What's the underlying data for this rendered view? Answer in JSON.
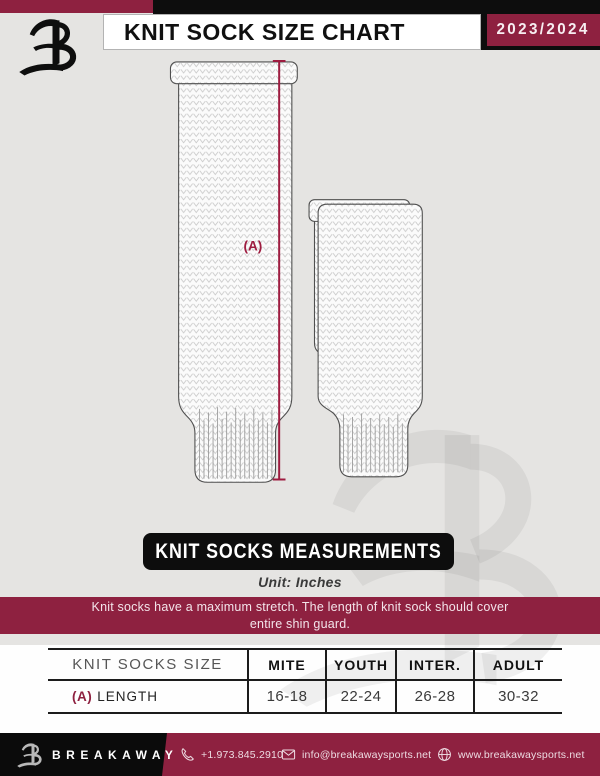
{
  "header": {
    "title": "KNIT SOCK SIZE CHART",
    "season": "2023/2024"
  },
  "diagram": {
    "label_a": "(A)"
  },
  "measurements": {
    "banner": "KNIT SOCKS MEASUREMENTS",
    "unit": "Unit: Inches",
    "note_line1": "Knit socks have a maximum stretch. The length of knit sock should cover",
    "note_line2": "entire shin guard."
  },
  "size_table": {
    "title": "KNIT SOCKS SIZE",
    "columns": [
      "MITE",
      "YOUTH",
      "INTER.",
      "ADULT"
    ],
    "rows": [
      {
        "prefix": "(A)",
        "label": "LENGTH",
        "values": [
          "16-18",
          "22-24",
          "26-28",
          "30-32"
        ]
      }
    ]
  },
  "footer": {
    "brand": "BREAKAWAY",
    "phone": "+1.973.845.2910",
    "email": "info@breakawaysports.net",
    "website": "www.breakawaysports.net",
    "icons": {
      "phone": "phone-icon",
      "email": "mail-icon",
      "website": "globe-icon"
    }
  },
  "colors": {
    "maroon": "#8e2140",
    "accent_line": "#9e1c40",
    "black": "#0d0d0d",
    "background_grey": "#e5e4e2"
  }
}
